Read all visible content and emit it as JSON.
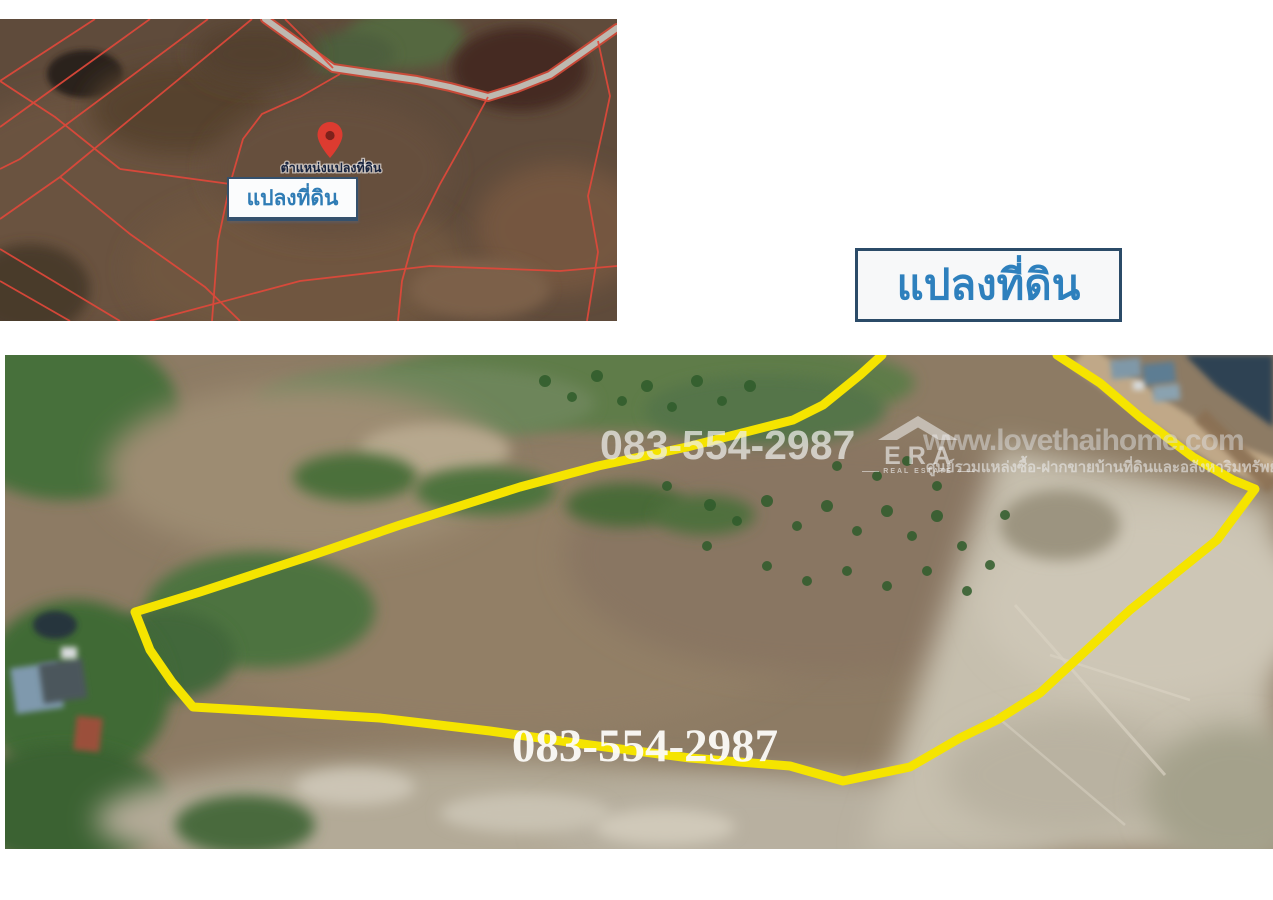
{
  "canvas": {
    "background": "#ffffff"
  },
  "inset_map": {
    "pin_caption": "ตำแหน่งแปลงที่ดิน",
    "label_box": "แปลงที่ดิน",
    "parcel_line_color": "#e0483a",
    "pin_color": "#dd3b30"
  },
  "title_box": {
    "label": "แปลงที่ดิน",
    "text_color": "#2e80bd",
    "border_color": "#2b4b68"
  },
  "aerial": {
    "phone_top": "083-554-2987",
    "phone_bottom": "083-554-2987",
    "boundary_color": "#f5e400",
    "boundary_points": "877,0 855,20 818,50 788,65 682,92 593,111 515,132 395,170 305,201 195,237 130,257 145,295 167,327 188,352 275,357 375,363 485,376 585,390 685,403 785,411 838,426 905,412 955,383 992,365 1035,338 1125,255 1212,185 1250,134 1228,125 1188,102 1135,62 1095,28 1052,0",
    "watermark": {
      "site_url": "www.lovethaihome.com",
      "tagline": "ศูนย์รวมแหล่งซื้อ-ฝากขายบ้านที่ดินและอสังหาริมทรัพย์",
      "brand": "ERA",
      "brand_sub": "REAL ESTATE"
    }
  }
}
